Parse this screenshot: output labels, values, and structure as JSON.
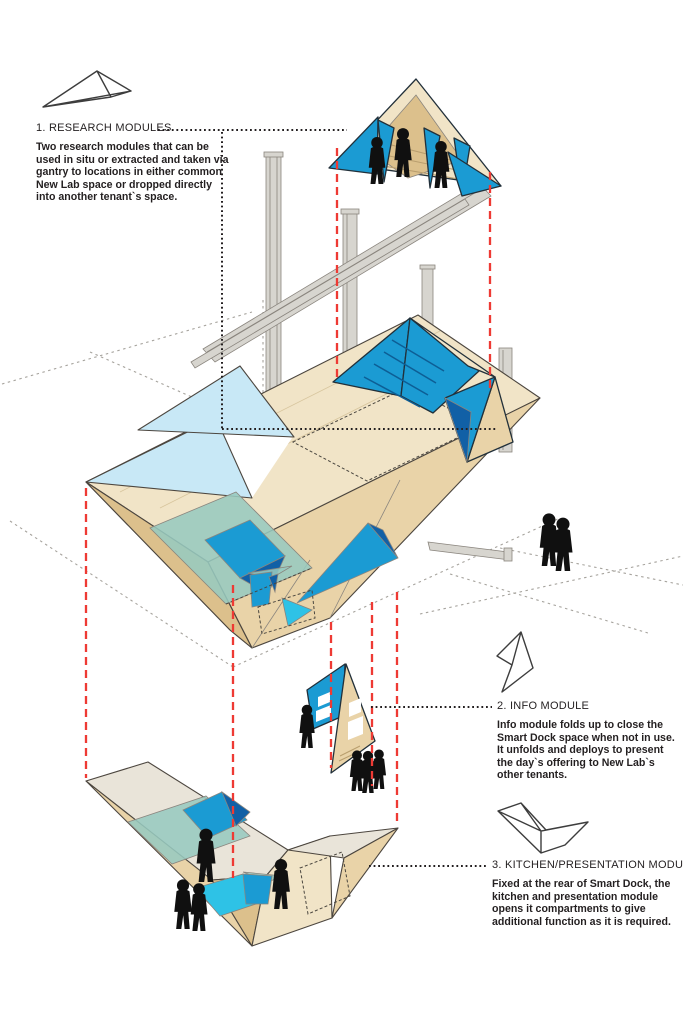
{
  "colors": {
    "accent_red": "#ee3a34",
    "bright_blue": "#1b9bd3",
    "dark_blue": "#1160a6",
    "pale_blue": "#c8e8f6",
    "teal": "#97c9bf",
    "cyan": "#2ec2e6",
    "stripe_blue": "#0d5e95",
    "wood_light": "#f1e4c7",
    "wood_mid": "#e9d3a8",
    "wood_deep": "#dcc08c",
    "steel": "#d7d5cf",
    "canvas_gray": "#e9e4d9",
    "ink": "#231f20",
    "line_dark": "#4c463f"
  },
  "annotations": {
    "research": {
      "heading": "1. RESEARCH MODULES",
      "body": "Two research modules that can be used in situ or extracted and taken via gantry to locations in either common New Lab space or dropped directly into another tenant`s space."
    },
    "info": {
      "heading": "2. INFO MODULE",
      "body": "Info module folds up to close the Smart Dock space when not in use.  It unfolds and deploys to present the day`s offering to New Lab`s other tenants."
    },
    "kitchen": {
      "heading": "3. KITCHEN/PRESENTATION MODULE",
      "body": "Fixed at the rear of Smart Dock, the kitchen and presentation module opens it compartments to give additional function as it is required."
    }
  },
  "figures": {
    "extracted_module_people": 3,
    "bystanders": 2,
    "info_module_people": 4,
    "kitchen_module_people": 4
  }
}
